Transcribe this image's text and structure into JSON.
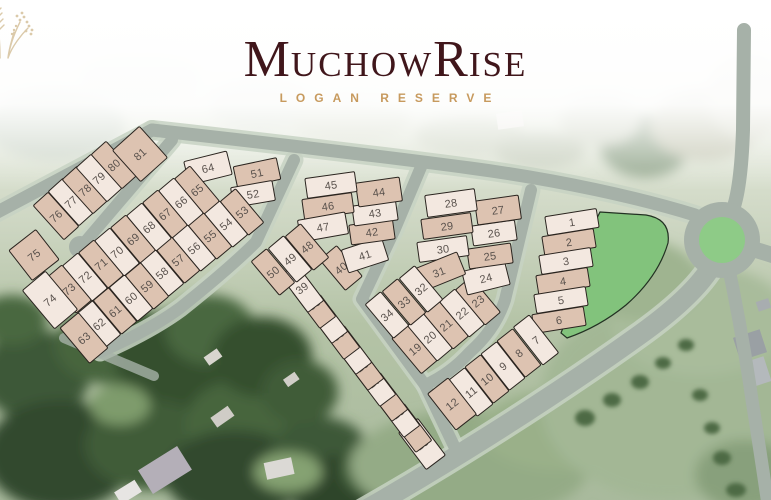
{
  "logo": {
    "title": "MuchowRise",
    "title_parts": [
      {
        "text": "M",
        "size": "big"
      },
      {
        "text": "UCHOW",
        "size": "small"
      },
      {
        "text": "R",
        "size": "big"
      },
      {
        "text": "ISE",
        "size": "small"
      }
    ],
    "subtitle": "LOGAN RESERVE",
    "colors": {
      "title": "#40161b",
      "subtitle": "#c79a5e",
      "sprig": "#d5c19c"
    }
  },
  "map": {
    "colors": {
      "lot_light": "#f3e8e0",
      "lot_tan": "#ddc3b1",
      "lot_stroke": "#2a241f",
      "lot_number": "#5a524d",
      "road": "#a6b1a8",
      "road_verge": "#c7d2c3",
      "park": "#82c37c",
      "roundabout": "#8ecb87"
    },
    "lots": [
      {
        "n": 1,
        "x": 572,
        "y": 222,
        "w": 52,
        "h": 19,
        "r": -9,
        "s": "light"
      },
      {
        "n": 2,
        "x": 569,
        "y": 242,
        "w": 52,
        "h": 19,
        "r": -9,
        "s": "tan"
      },
      {
        "n": 3,
        "x": 566,
        "y": 261,
        "w": 52,
        "h": 19,
        "r": -9,
        "s": "light"
      },
      {
        "n": 4,
        "x": 563,
        "y": 281,
        "w": 52,
        "h": 19,
        "r": -9,
        "s": "tan"
      },
      {
        "n": 5,
        "x": 561,
        "y": 300,
        "w": 52,
        "h": 19,
        "r": -9,
        "s": "light"
      },
      {
        "n": 6,
        "x": 559,
        "y": 320,
        "w": 52,
        "h": 19,
        "r": -9,
        "s": "tan"
      },
      {
        "n": 7,
        "x": 536,
        "y": 340,
        "w": 20,
        "h": 48,
        "r": -38,
        "s": "light"
      },
      {
        "n": 8,
        "x": 519,
        "y": 353,
        "w": 20,
        "h": 46,
        "r": -38,
        "s": "tan"
      },
      {
        "n": 9,
        "x": 503,
        "y": 366,
        "w": 20,
        "h": 46,
        "r": -38,
        "s": "light"
      },
      {
        "n": 10,
        "x": 487,
        "y": 379,
        "w": 20,
        "h": 46,
        "r": -38,
        "s": "tan"
      },
      {
        "n": 11,
        "x": 471,
        "y": 392,
        "w": 20,
        "h": 46,
        "r": -38,
        "s": "light"
      },
      {
        "n": 12,
        "x": 452,
        "y": 404,
        "w": 26,
        "h": 46,
        "r": -38,
        "s": "tan"
      },
      {
        "n": 13,
        "x": 422,
        "y": 444,
        "w": 24,
        "h": 46,
        "r": -37,
        "s": "light"
      },
      {
        "n": 14,
        "x": 410,
        "y": 428,
        "w": 20,
        "h": 46,
        "r": -37,
        "s": "tan"
      },
      {
        "n": 15,
        "x": 398,
        "y": 413,
        "w": 20,
        "h": 46,
        "r": -37,
        "s": "light"
      },
      {
        "n": 16,
        "x": 386,
        "y": 397,
        "w": 20,
        "h": 46,
        "r": -37,
        "s": "tan"
      },
      {
        "n": 17,
        "x": 374,
        "y": 382,
        "w": 20,
        "h": 46,
        "r": -37,
        "s": "light"
      },
      {
        "n": 18,
        "x": 362,
        "y": 366,
        "w": 20,
        "h": 46,
        "r": -37,
        "s": "tan"
      },
      {
        "n": 19,
        "x": 415,
        "y": 349,
        "w": 22,
        "h": 46,
        "r": -40,
        "s": "tan"
      },
      {
        "n": 20,
        "x": 430,
        "y": 337,
        "w": 20,
        "h": 46,
        "r": -40,
        "s": "light"
      },
      {
        "n": 21,
        "x": 446,
        "y": 325,
        "w": 20,
        "h": 46,
        "r": -40,
        "s": "tan"
      },
      {
        "n": 22,
        "x": 462,
        "y": 313,
        "w": 20,
        "h": 46,
        "r": -40,
        "s": "light"
      },
      {
        "n": 23,
        "x": 478,
        "y": 301,
        "w": 20,
        "h": 46,
        "r": -40,
        "s": "tan"
      },
      {
        "n": 24,
        "x": 486,
        "y": 278,
        "w": 44,
        "h": 24,
        "r": -14,
        "s": "light"
      },
      {
        "n": 25,
        "x": 490,
        "y": 256,
        "w": 44,
        "h": 20,
        "r": -8,
        "s": "tan"
      },
      {
        "n": 26,
        "x": 494,
        "y": 233,
        "w": 44,
        "h": 20,
        "r": -8,
        "s": "light"
      },
      {
        "n": 27,
        "x": 498,
        "y": 210,
        "w": 44,
        "h": 24,
        "r": -8,
        "s": "tan"
      },
      {
        "n": 28,
        "x": 451,
        "y": 203,
        "w": 50,
        "h": 22,
        "r": -8,
        "s": "light"
      },
      {
        "n": 29,
        "x": 447,
        "y": 226,
        "w": 50,
        "h": 20,
        "r": -8,
        "s": "tan"
      },
      {
        "n": 30,
        "x": 443,
        "y": 249,
        "w": 50,
        "h": 20,
        "r": -8,
        "s": "light"
      },
      {
        "n": 31,
        "x": 439,
        "y": 272,
        "w": 48,
        "h": 24,
        "r": -22,
        "s": "tan"
      },
      {
        "n": 32,
        "x": 421,
        "y": 289,
        "w": 20,
        "h": 44,
        "r": -40,
        "s": "light"
      },
      {
        "n": 33,
        "x": 404,
        "y": 302,
        "w": 20,
        "h": 44,
        "r": -40,
        "s": "tan"
      },
      {
        "n": 34,
        "x": 387,
        "y": 315,
        "w": 20,
        "h": 44,
        "r": -40,
        "s": "light"
      },
      {
        "n": 35,
        "x": 350,
        "y": 350,
        "w": 20,
        "h": 46,
        "r": -37,
        "s": "light"
      },
      {
        "n": 36,
        "x": 338,
        "y": 335,
        "w": 20,
        "h": 46,
        "r": -37,
        "s": "tan"
      },
      {
        "n": 37,
        "x": 326,
        "y": 319,
        "w": 20,
        "h": 46,
        "r": -37,
        "s": "light"
      },
      {
        "n": 38,
        "x": 314,
        "y": 304,
        "w": 20,
        "h": 46,
        "r": -37,
        "s": "tan"
      },
      {
        "n": 39,
        "x": 302,
        "y": 288,
        "w": 20,
        "h": 46,
        "r": -37,
        "s": "light"
      },
      {
        "n": 40,
        "x": 341,
        "y": 268,
        "w": 22,
        "h": 40,
        "r": -40,
        "s": "tan"
      },
      {
        "n": 41,
        "x": 365,
        "y": 255,
        "w": 42,
        "h": 24,
        "r": -18,
        "s": "light"
      },
      {
        "n": 42,
        "x": 372,
        "y": 232,
        "w": 44,
        "h": 20,
        "r": -8,
        "s": "tan"
      },
      {
        "n": 43,
        "x": 375,
        "y": 213,
        "w": 44,
        "h": 20,
        "r": -8,
        "s": "light"
      },
      {
        "n": 44,
        "x": 379,
        "y": 192,
        "w": 44,
        "h": 24,
        "r": -8,
        "s": "tan"
      },
      {
        "n": 45,
        "x": 331,
        "y": 185,
        "w": 50,
        "h": 20,
        "r": -8,
        "s": "light"
      },
      {
        "n": 46,
        "x": 328,
        "y": 206,
        "w": 50,
        "h": 20,
        "r": -8,
        "s": "tan"
      },
      {
        "n": 47,
        "x": 323,
        "y": 227,
        "w": 48,
        "h": 22,
        "r": -10,
        "s": "light"
      },
      {
        "n": 48,
        "x": 307,
        "y": 247,
        "w": 20,
        "h": 44,
        "r": -40,
        "s": "tan"
      },
      {
        "n": 49,
        "x": 290,
        "y": 259,
        "w": 20,
        "h": 44,
        "r": -40,
        "s": "light"
      },
      {
        "n": 50,
        "x": 273,
        "y": 272,
        "w": 20,
        "h": 44,
        "r": -40,
        "s": "tan"
      },
      {
        "n": 51,
        "x": 257,
        "y": 173,
        "w": 44,
        "h": 22,
        "r": -12,
        "s": "tan"
      },
      {
        "n": 52,
        "x": 253,
        "y": 194,
        "w": 42,
        "h": 20,
        "r": -10,
        "s": "light"
      },
      {
        "n": 53,
        "x": 242,
        "y": 212,
        "w": 20,
        "h": 44,
        "r": -40,
        "s": "tan"
      },
      {
        "n": 54,
        "x": 226,
        "y": 224,
        "w": 20,
        "h": 44,
        "r": -40,
        "s": "light"
      },
      {
        "n": 55,
        "x": 210,
        "y": 236,
        "w": 20,
        "h": 44,
        "r": -40,
        "s": "tan"
      },
      {
        "n": 56,
        "x": 194,
        "y": 248,
        "w": 20,
        "h": 44,
        "r": -40,
        "s": "light"
      },
      {
        "n": 57,
        "x": 178,
        "y": 260,
        "w": 20,
        "h": 44,
        "r": -40,
        "s": "tan"
      },
      {
        "n": 58,
        "x": 162,
        "y": 273,
        "w": 20,
        "h": 44,
        "r": -40,
        "s": "light"
      },
      {
        "n": 59,
        "x": 147,
        "y": 286,
        "w": 20,
        "h": 44,
        "r": -40,
        "s": "tan"
      },
      {
        "n": 60,
        "x": 131,
        "y": 298,
        "w": 20,
        "h": 44,
        "r": -40,
        "s": "light"
      },
      {
        "n": 61,
        "x": 115,
        "y": 311,
        "w": 20,
        "h": 44,
        "r": -40,
        "s": "tan"
      },
      {
        "n": 62,
        "x": 99,
        "y": 324,
        "w": 20,
        "h": 44,
        "r": -40,
        "s": "light"
      },
      {
        "n": 63,
        "x": 84,
        "y": 338,
        "w": 24,
        "h": 46,
        "r": -40,
        "s": "tan"
      },
      {
        "n": 64,
        "x": 208,
        "y": 168,
        "w": 44,
        "h": 24,
        "r": -14,
        "s": "light"
      },
      {
        "n": 65,
        "x": 197,
        "y": 190,
        "w": 20,
        "h": 46,
        "r": -40,
        "s": "tan"
      },
      {
        "n": 66,
        "x": 181,
        "y": 202,
        "w": 20,
        "h": 46,
        "r": -40,
        "s": "light"
      },
      {
        "n": 67,
        "x": 165,
        "y": 214,
        "w": 20,
        "h": 46,
        "r": -40,
        "s": "tan"
      },
      {
        "n": 68,
        "x": 149,
        "y": 227,
        "w": 20,
        "h": 46,
        "r": -40,
        "s": "light"
      },
      {
        "n": 69,
        "x": 133,
        "y": 239,
        "w": 20,
        "h": 46,
        "r": -40,
        "s": "tan"
      },
      {
        "n": 70,
        "x": 117,
        "y": 252,
        "w": 20,
        "h": 46,
        "r": -40,
        "s": "light"
      },
      {
        "n": 71,
        "x": 101,
        "y": 264,
        "w": 20,
        "h": 46,
        "r": -40,
        "s": "tan"
      },
      {
        "n": 72,
        "x": 85,
        "y": 277,
        "w": 20,
        "h": 46,
        "r": -40,
        "s": "light"
      },
      {
        "n": 73,
        "x": 69,
        "y": 289,
        "w": 20,
        "h": 46,
        "r": -40,
        "s": "tan"
      },
      {
        "n": 74,
        "x": 50,
        "y": 300,
        "w": 30,
        "h": 50,
        "r": -40,
        "s": "light"
      },
      {
        "n": 75,
        "x": 34,
        "y": 255,
        "w": 34,
        "h": 38,
        "r": -38,
        "s": "tan"
      },
      {
        "n": 76,
        "x": 56,
        "y": 216,
        "w": 20,
        "h": 46,
        "r": -42,
        "s": "tan"
      },
      {
        "n": 77,
        "x": 71,
        "y": 202,
        "w": 20,
        "h": 46,
        "r": -42,
        "s": "light"
      },
      {
        "n": 78,
        "x": 85,
        "y": 190,
        "w": 20,
        "h": 46,
        "r": -42,
        "s": "tan"
      },
      {
        "n": 79,
        "x": 99,
        "y": 178,
        "w": 20,
        "h": 46,
        "r": -42,
        "s": "light"
      },
      {
        "n": 80,
        "x": 114,
        "y": 165,
        "w": 20,
        "h": 46,
        "r": -42,
        "s": "tan"
      },
      {
        "n": 81,
        "x": 140,
        "y": 154,
        "w": 36,
        "h": 42,
        "r": -42,
        "s": "tan"
      }
    ]
  }
}
